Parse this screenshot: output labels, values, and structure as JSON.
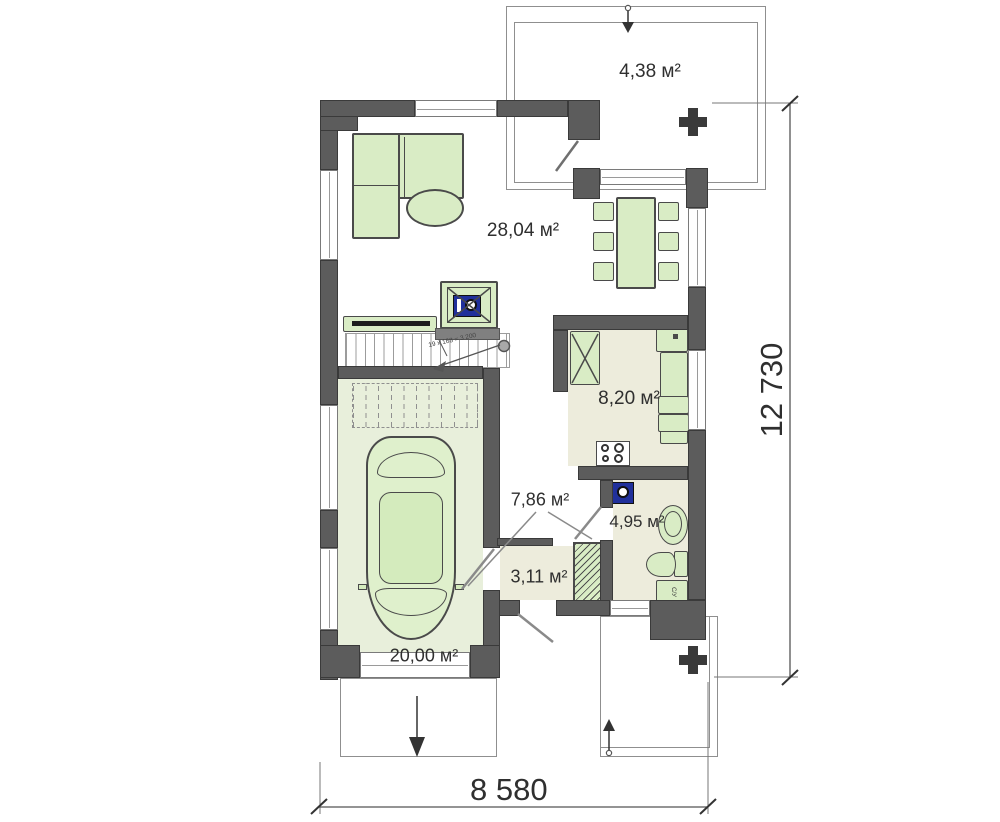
{
  "plan": {
    "type": "house-floor-plan-ground-floor",
    "rooms": [
      {
        "id": "terrace",
        "area_label": "4,38 м²"
      },
      {
        "id": "living-dining",
        "area_label": "28,04 м²"
      },
      {
        "id": "kitchen",
        "area_label": "8,20 м²"
      },
      {
        "id": "hall",
        "area_label": "7,86 м²"
      },
      {
        "id": "bathroom",
        "area_label": "4,95 м²"
      },
      {
        "id": "vestibule",
        "area_label": "3,11 м²"
      },
      {
        "id": "garage",
        "area_label": "20,00 м²"
      }
    ],
    "dimensions": {
      "overall_width_mm": "8 580",
      "overall_height_mm": "12 730"
    },
    "annotations": {
      "stairs_note": "19 x 168 = 3 200",
      "bath_unit_label": "С/У"
    },
    "colors": {
      "wall": "#5c5c5c",
      "furniture_fill": "#d9ecc5",
      "garage_floor": "#e8efdb",
      "wet_floor": "#edecdc",
      "appliance_blue": "#20309b"
    }
  }
}
